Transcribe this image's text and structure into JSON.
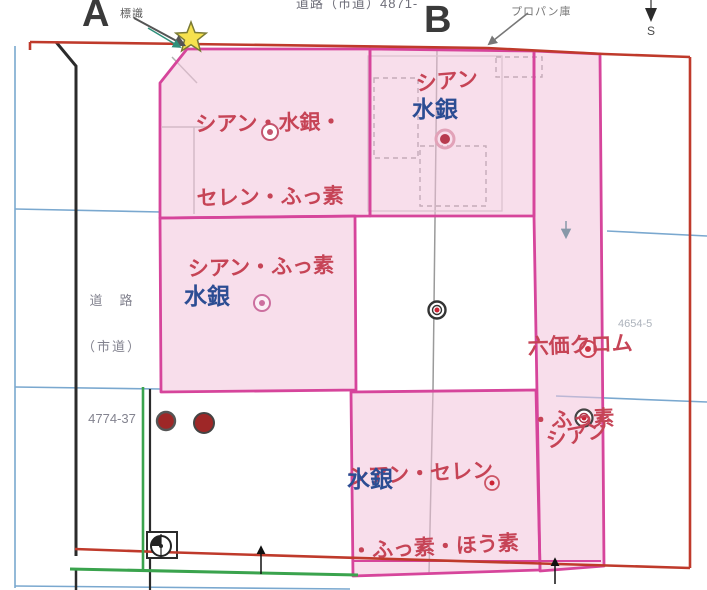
{
  "header": {
    "point_a_label": "A",
    "point_a_note": "標識",
    "top_road_label": "道路（市道）4871-",
    "point_b_label": "B",
    "propane_label": "プロパン庫",
    "compass_south_label": "S"
  },
  "side_road": {
    "name_line1": "道　路",
    "name_line2": "（市道）",
    "parcel_number": "4774-37"
  },
  "zones": {
    "top_left": {
      "red_line1": "シアン・水銀・",
      "red_line2": "セレン・ふっ素"
    },
    "top_middle": {
      "red": "シアン",
      "blue": "水銀"
    },
    "middle": {
      "red": "シアン・ふっ素",
      "blue": "水銀"
    },
    "right_column": {
      "red_line1": "六価クロム",
      "red_line2": "・ふっ素"
    },
    "bottom_middle": {
      "red_line1": "シアン・セレン",
      "red_line2": "・ふっ素・ほう素",
      "blue": "水銀"
    },
    "bottom_right": {
      "red": "シアン"
    }
  },
  "faint_parcel_number": "4654-5",
  "colors": {
    "zone_fill": "#f2c3da",
    "zone_border": "#d6459b",
    "site_boundary_red": "#bf3a2b",
    "contaminant_text_red": "#c64456",
    "mercury_text_blue": "#2c4d93",
    "parcel_line_blue": "#7aa8cf",
    "survey_line_green": "#3aa34d",
    "star_yellow": "#f6e14e"
  }
}
